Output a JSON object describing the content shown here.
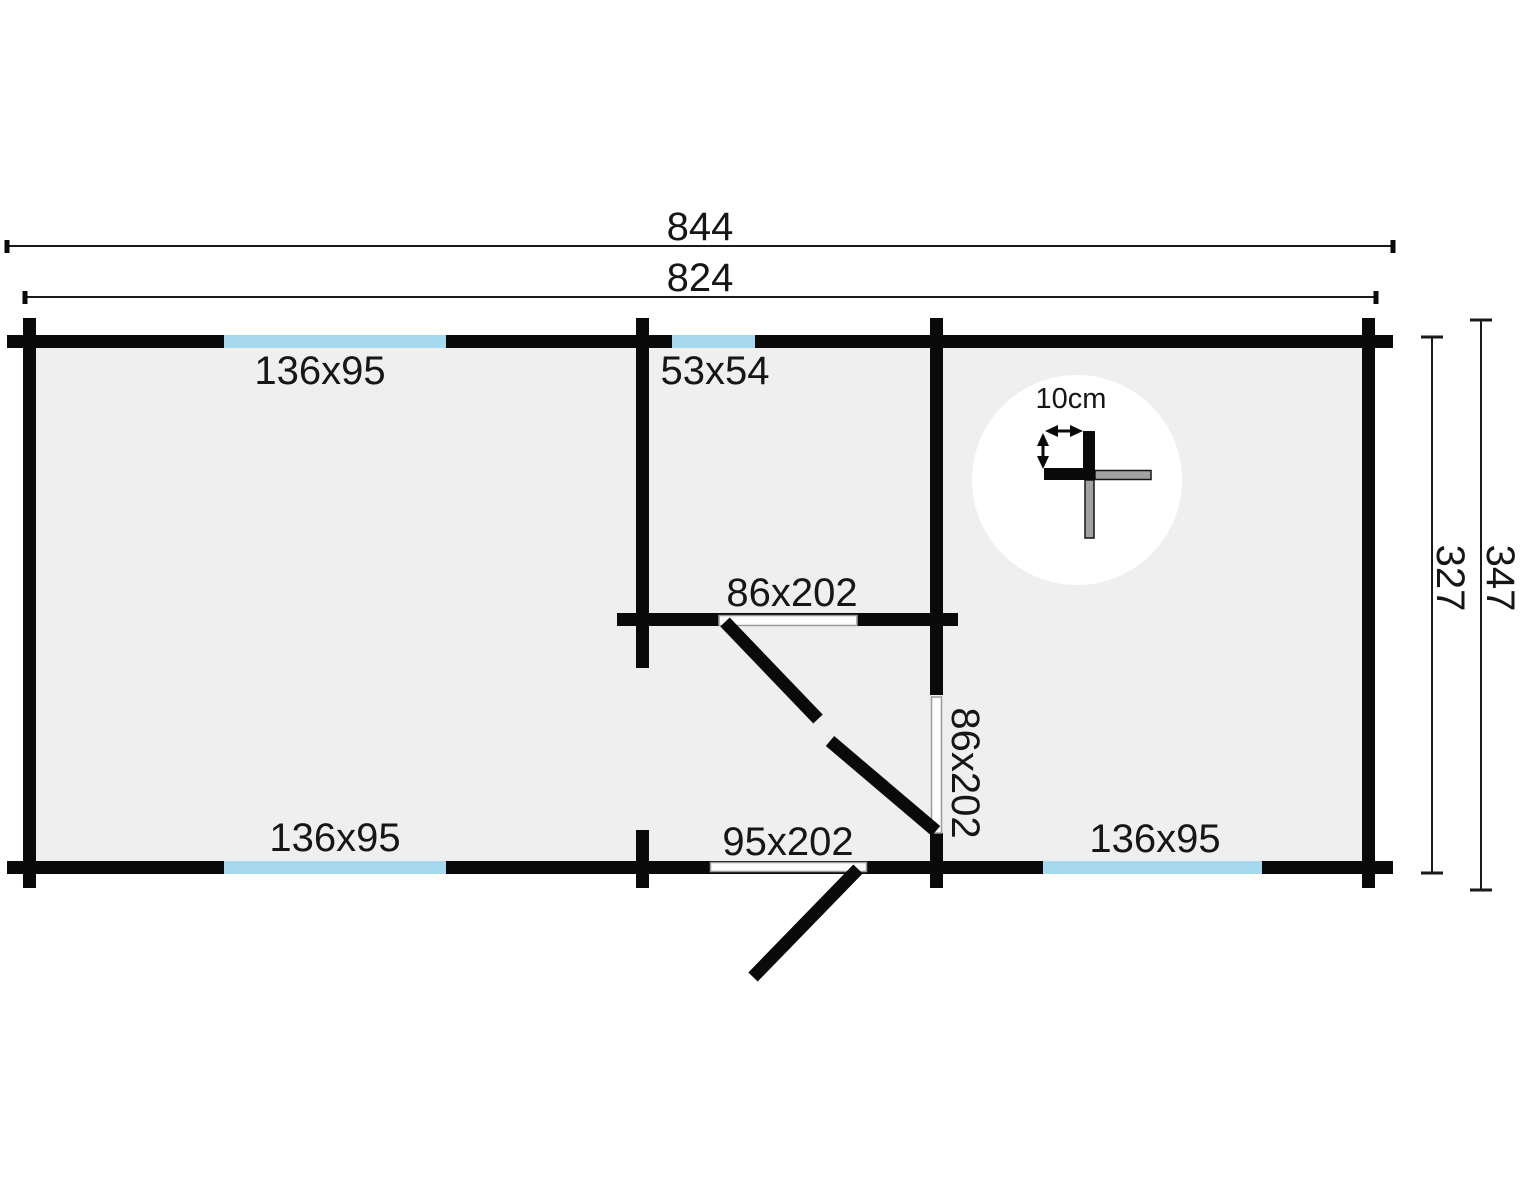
{
  "floor_plan": {
    "type": "log-cabin-floor-plan",
    "dimension_labels": {
      "outer_width": "844",
      "inner_width": "824",
      "outer_depth": "347",
      "inner_depth": "327"
    },
    "opening_labels": {
      "window_top_left": "136x95",
      "window_top_middle": "53x54",
      "interior_door_top": "86x202",
      "interior_door_side": "86x202",
      "window_bottom_left": "136x95",
      "exterior_door_bottom": "95x202",
      "window_bottom_right": "136x95"
    },
    "detail_callout": {
      "wall_thickness": "10cm"
    },
    "colors": {
      "wall": "#0a0a0a",
      "floor": "#efefef",
      "window": "#a6d8ee",
      "door_leaf_opening": "#fdfdfd",
      "door_opening_outline": "#9a9a9a",
      "log_gray": "#a2a2a2",
      "background": "#ffffff"
    }
  }
}
